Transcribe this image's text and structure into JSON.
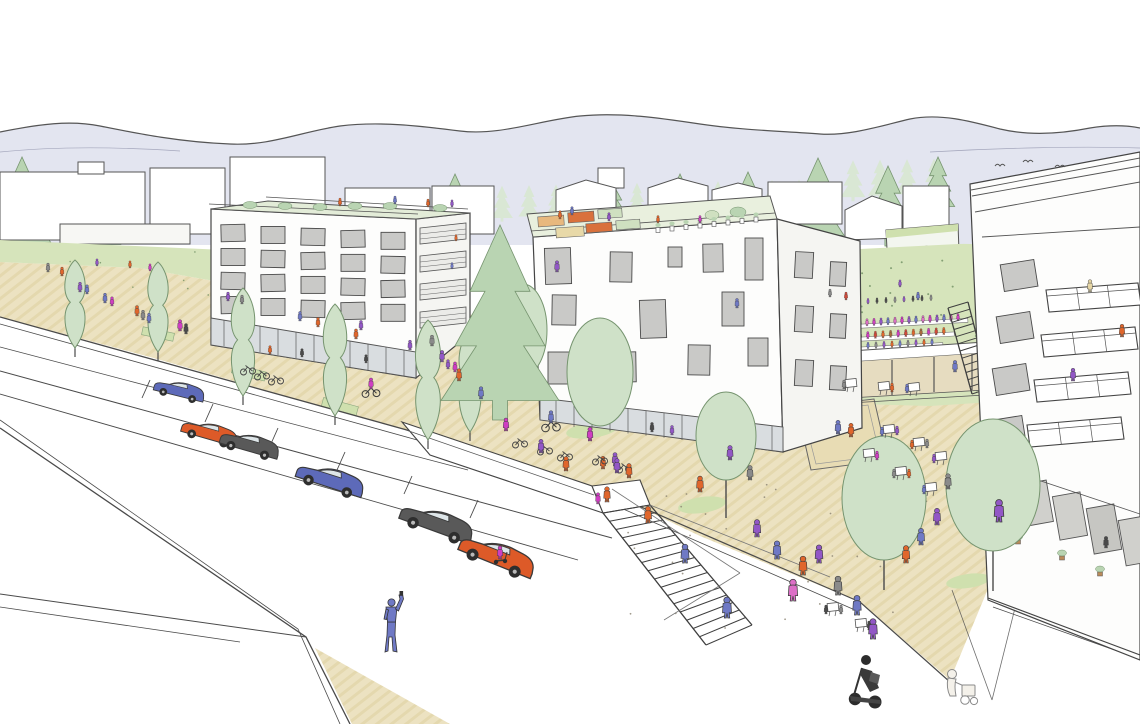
{
  "meta": {
    "title": "Urban design concept sketch",
    "description": "Hand-drawn architectural perspective: two white mid-rise buildings with roof gardens, tree-lined street with parked cars, stepped pedestrian plaza with cafe terraces, terraced restaurant seating on a lawn, tall balcony building at right, mountain ridge in background"
  },
  "palette": {
    "outline": "#4a4a4a",
    "sky_band": "#e3e5f0",
    "paving": "#ece2c1",
    "paving_stripe": "#ddcf9e",
    "lawn": "#d6e4bb",
    "tree_light": "#cfe1c8",
    "tree_mid": "#b9d4b2",
    "tree_bg": "#d9e7d4",
    "tree_stroke": "#76946f",
    "window_gray": "#c9c9c7",
    "glass": "#d9dde0",
    "court_sand": "#e8dcb4",
    "building_white": "#fdfdfc",
    "building_side": "#f5f5f2",
    "white": "#ffffff",
    "people": {
      "orange": "#e0662c",
      "magenta": "#cf3ec2",
      "pink": "#dc6ec6",
      "purple": "#9257c6",
      "violet": "#6f79c5",
      "gray": "#8a8a8a",
      "dark": "#4a4a4a",
      "red": "#cf4a3a",
      "beige": "#e5d5a4",
      "brown": "#a9683c"
    },
    "cars": {
      "blue": "#5d6ab9",
      "orange": "#dd5a28",
      "dark": "#595959"
    }
  },
  "scene": {
    "people_layers": {
      "background": [
        [
          48,
          272,
          "gray",
          0.62
        ],
        [
          62,
          276,
          "orange",
          0.62
        ],
        [
          80,
          292,
          "purple",
          0.68
        ],
        [
          87,
          294,
          "violet",
          0.64
        ],
        [
          105,
          303,
          "violet",
          0.68
        ],
        [
          112,
          306,
          "magenta",
          0.64
        ],
        [
          130,
          268,
          "orange",
          0.5
        ],
        [
          150,
          271,
          "magenta",
          0.5
        ],
        [
          97,
          266,
          "purple",
          0.5
        ],
        [
          137,
          316,
          "orange",
          0.72
        ],
        [
          143,
          320,
          "gray",
          0.68
        ],
        [
          149,
          323,
          "violet",
          0.68
        ],
        [
          180,
          331,
          "magenta",
          0.78
        ],
        [
          186,
          334,
          "dark",
          0.72
        ],
        [
          228,
          301,
          "purple",
          0.62
        ],
        [
          242,
          304,
          "gray",
          0.62
        ],
        [
          300,
          321,
          "violet",
          0.66
        ],
        [
          318,
          327,
          "orange",
          0.66
        ],
        [
          356,
          339,
          "orange",
          0.7
        ],
        [
          410,
          350,
          "purple",
          0.68
        ],
        [
          846,
          300,
          "red",
          0.55
        ],
        [
          830,
          297,
          "gray",
          0.55
        ],
        [
          900,
          287,
          "purple",
          0.5
        ],
        [
          918,
          300,
          "violet",
          0.55
        ]
      ],
      "roof": [
        [
          340,
          206,
          "orange",
          0.55
        ],
        [
          395,
          204,
          "violet",
          0.55
        ],
        [
          428,
          207,
          "orange",
          0.55
        ],
        [
          452,
          207,
          "purple",
          0.5
        ],
        [
          560,
          219,
          "orange",
          0.58
        ],
        [
          572,
          215,
          "violet",
          0.58
        ],
        [
          609,
          221,
          "purple",
          0.58
        ],
        [
          658,
          223,
          "orange",
          0.52
        ],
        [
          700,
          223,
          "magenta",
          0.52
        ]
      ],
      "window": [
        [
          361,
          330,
          "purple",
          0.66
        ],
        [
          557,
          272,
          "purple",
          0.78
        ],
        [
          737,
          308,
          "violet",
          0.66
        ]
      ],
      "balcony": [
        [
          1090,
          292,
          "beige",
          0.85
        ],
        [
          1122,
          337,
          "orange",
          0.88
        ],
        [
          1073,
          381,
          "purple",
          0.88
        ],
        [
          456,
          241,
          "orange",
          0.45
        ],
        [
          452,
          269,
          "violet",
          0.45
        ]
      ],
      "interior": [
        [
          240,
          350,
          "dark",
          0.58
        ],
        [
          270,
          354,
          "orange",
          0.58
        ],
        [
          302,
          357,
          "dark",
          0.58
        ],
        [
          332,
          360,
          "purple",
          0.58
        ],
        [
          366,
          363,
          "dark",
          0.58
        ],
        [
          652,
          432,
          "dark",
          0.66
        ],
        [
          672,
          435,
          "purple",
          0.66
        ],
        [
          700,
          438,
          "dark",
          0.66
        ],
        [
          722,
          440,
          "orange",
          0.66
        ],
        [
          746,
          442,
          "dark",
          0.66
        ],
        [
          1008,
          512,
          "brown",
          0.8
        ],
        [
          1106,
          548,
          "dark",
          0.8
        ]
      ],
      "stairs_bridge": [
        [
          615,
          466,
          "purple",
          0.92
        ],
        [
          603,
          469,
          "orange",
          0.88
        ],
        [
          607,
          502,
          "orange",
          1.05
        ],
        [
          598,
          504,
          "magenta",
          0.78
        ],
        [
          727,
          618,
          "violet",
          1.45
        ],
        [
          793,
          601,
          "pink",
          1.5
        ],
        [
          955,
          372,
          "violet",
          0.8
        ]
      ],
      "plaza": [
        [
          617,
          473,
          "purple",
          1.0
        ],
        [
          629,
          478,
          "orange",
          1.0
        ],
        [
          648,
          523,
          "orange",
          1.15
        ],
        [
          685,
          563,
          "violet",
          1.3
        ],
        [
          757,
          537,
          "purple",
          1.2
        ],
        [
          777,
          559,
          "violet",
          1.25
        ],
        [
          803,
          575,
          "orange",
          1.3
        ],
        [
          819,
          563,
          "purple",
          1.25
        ],
        [
          838,
          595,
          "gray",
          1.3
        ],
        [
          857,
          615,
          "violet",
          1.35
        ],
        [
          873,
          639,
          "purple",
          1.4
        ],
        [
          906,
          563,
          "orange",
          1.2
        ],
        [
          921,
          545,
          "violet",
          1.15
        ],
        [
          937,
          525,
          "purple",
          1.15
        ],
        [
          851,
          437,
          "orange",
          0.95
        ],
        [
          838,
          434,
          "violet",
          0.95
        ],
        [
          999,
          522,
          "purple",
          1.55
        ],
        [
          948,
          489,
          "gray",
          1.05
        ],
        [
          700,
          492,
          "orange",
          1.1
        ],
        [
          590,
          441,
          "magenta",
          0.95
        ],
        [
          566,
          471,
          "orange",
          1.0
        ],
        [
          541,
          453,
          "purple",
          0.95
        ],
        [
          506,
          431,
          "magenta",
          0.9
        ],
        [
          481,
          399,
          "violet",
          0.85
        ],
        [
          459,
          381,
          "orange",
          0.85
        ],
        [
          442,
          362,
          "purple",
          0.8
        ],
        [
          432,
          346,
          "gray",
          0.75
        ],
        [
          750,
          480,
          "gray",
          1.0
        ],
        [
          730,
          460,
          "purple",
          1.0
        ],
        [
          455,
          372,
          "magenta",
          0.7
        ],
        [
          448,
          369,
          "purple",
          0.65
        ]
      ]
    },
    "cars": [
      [
        178,
        396,
        0.85,
        14,
        "blue"
      ],
      [
        208,
        439,
        0.95,
        16,
        "orange"
      ],
      [
        248,
        451,
        1.0,
        16,
        "dark"
      ],
      [
        328,
        487,
        1.15,
        18,
        "blue"
      ],
      [
        434,
        531,
        1.25,
        20,
        "dark"
      ],
      [
        494,
        564,
        1.3,
        22,
        "orange"
      ]
    ],
    "trees": {
      "columnar": [
        [
          75,
          348,
          88,
          26
        ],
        [
          158,
          352,
          90,
          26
        ],
        [
          243,
          396,
          108,
          30
        ],
        [
          335,
          416,
          112,
          30
        ],
        [
          428,
          440,
          120,
          32
        ],
        [
          470,
          432,
          102,
          28
        ]
      ],
      "round": [
        [
          600,
          372,
          33,
          54,
          0
        ],
        [
          523,
          330,
          24,
          46,
          0
        ],
        [
          726,
          436,
          30,
          44,
          38
        ],
        [
          884,
          498,
          42,
          62,
          30
        ],
        [
          993,
          485,
          47,
          66,
          40
        ]
      ],
      "conifer_front": [
        [
          500,
          420,
          195
        ]
      ],
      "conifer_bg": [
        [
          22,
          252,
          95
        ],
        [
          95,
          253,
          85
        ],
        [
          262,
          252,
          78
        ],
        [
          455,
          232,
          58
        ],
        [
          818,
          244,
          86
        ],
        [
          888,
          246,
          80
        ],
        [
          938,
          212,
          55
        ],
        [
          612,
          216,
          42
        ],
        [
          680,
          214,
          40
        ],
        [
          748,
          216,
          44
        ]
      ]
    },
    "seating_rows": [
      {
        "x0": 850,
        "y": 305,
        "dx": 9.0,
        "n": 10,
        "slope": -0.055,
        "s": 0.4,
        "bench": false,
        "colors": [
          "dark",
          "gray",
          "purple",
          "dark"
        ]
      },
      {
        "x0": 846,
        "y": 327,
        "dx": 7.0,
        "n": 17,
        "slope": -0.055,
        "s": 0.5,
        "bench": true,
        "colors": [
          "magenta",
          "purple",
          "violet",
          "pink"
        ]
      },
      {
        "x0": 845,
        "y": 340,
        "dx": 7.6,
        "n": 14,
        "slope": -0.055,
        "s": 0.5,
        "bench": true,
        "colors": [
          "red",
          "orange",
          "brown",
          "magenta"
        ]
      },
      {
        "x0": 844,
        "y": 350,
        "dx": 8.0,
        "n": 12,
        "slope": -0.055,
        "s": 0.45,
        "bench": true,
        "colors": [
          "gray",
          "purple",
          "orange",
          "violet"
        ]
      }
    ],
    "tables": [
      {
        "x": 889,
        "y": 429,
        "seats": [
          [
            -7,
            3,
            "violet"
          ],
          [
            8,
            2,
            "purple"
          ]
        ]
      },
      {
        "x": 919,
        "y": 442,
        "seats": [
          [
            -7,
            3,
            "orange"
          ],
          [
            8,
            2,
            "gray"
          ]
        ]
      },
      {
        "x": 941,
        "y": 456,
        "seats": [
          [
            -7,
            3,
            "purple"
          ]
        ]
      },
      {
        "x": 869,
        "y": 453,
        "seats": [
          [
            8,
            3,
            "magenta"
          ]
        ]
      },
      {
        "x": 901,
        "y": 471,
        "seats": [
          [
            -7,
            3,
            "gray"
          ],
          [
            8,
            3,
            "orange"
          ]
        ]
      },
      {
        "x": 931,
        "y": 487,
        "seats": [
          [
            -7,
            3,
            "violet"
          ]
        ]
      },
      {
        "x": 833,
        "y": 607,
        "seats": [
          [
            -7,
            3,
            "dark"
          ],
          [
            8,
            3,
            "gray"
          ]
        ]
      },
      {
        "x": 861,
        "y": 623,
        "seats": [
          [
            8,
            3,
            "dark"
          ]
        ]
      },
      {
        "x": 851,
        "y": 383,
        "seats": [
          [
            -7,
            2,
            "gray"
          ]
        ]
      },
      {
        "x": 884,
        "y": 386,
        "seats": [
          [
            8,
            2,
            "orange"
          ]
        ]
      },
      {
        "x": 914,
        "y": 387,
        "seats": [
          [
            -7,
            2,
            "violet"
          ]
        ]
      }
    ],
    "stairs": [
      {
        "l": [
          603,
          513,
          706,
          645
        ],
        "r": [
          650,
          505,
          752,
          625
        ],
        "n": 16
      },
      {
        "l": [
          948,
          308,
          972,
          394
        ],
        "r": [
          968,
          302,
          990,
          388
        ],
        "n": 12
      }
    ],
    "bikes": [
      [
        248,
        372
      ],
      [
        262,
        377
      ],
      [
        276,
        382
      ],
      [
        520,
        445
      ],
      [
        545,
        452
      ],
      [
        565,
        458
      ],
      [
        600,
        462
      ],
      [
        624,
        470
      ]
    ],
    "cyclists": [
      [
        371,
        394,
        "magenta",
        0.9
      ],
      [
        551,
        428,
        "violet",
        1.0
      ]
    ],
    "scooters": [
      [
        500,
        561,
        "magenta"
      ]
    ],
    "left_win_grid": {
      "cols": 5,
      "rows": 4,
      "x0": 221,
      "dx": 40,
      "ys": [
        224,
        248,
        272,
        296
      ],
      "w": 24,
      "h": 17,
      "slope": 0.049,
      "xref": 211
    },
    "mid_windows": [
      [
        545,
        248,
        26,
        36,
        -2
      ],
      [
        610,
        252,
        22,
        30,
        1
      ],
      [
        668,
        247,
        14,
        20,
        0
      ],
      [
        703,
        244,
        20,
        28,
        -1
      ],
      [
        745,
        238,
        18,
        42,
        0
      ],
      [
        552,
        295,
        24,
        30,
        1
      ],
      [
        640,
        300,
        26,
        38,
        -2
      ],
      [
        722,
        292,
        22,
        34,
        0
      ],
      [
        548,
        352,
        26,
        32,
        0
      ],
      [
        612,
        352,
        24,
        30,
        -1
      ],
      [
        688,
        345,
        22,
        30,
        1
      ],
      [
        748,
        338,
        20,
        28,
        0
      ],
      [
        795,
        252,
        18,
        26,
        3
      ],
      [
        830,
        262,
        16,
        24,
        3
      ],
      [
        795,
        306,
        18,
        26,
        3
      ],
      [
        830,
        314,
        16,
        24,
        3
      ],
      [
        795,
        360,
        18,
        26,
        3
      ],
      [
        830,
        366,
        16,
        24,
        3
      ]
    ],
    "right_windows": [
      [
        1002,
        262
      ],
      [
        998,
        314
      ],
      [
        994,
        366
      ],
      [
        990,
        418
      ],
      [
        987,
        470
      ]
    ],
    "balconies": [
      [
        1046,
        290,
        1138,
        283
      ],
      [
        1041,
        335,
        1135,
        327
      ],
      [
        1034,
        380,
        1128,
        372
      ],
      [
        1027,
        425,
        1121,
        417
      ]
    ],
    "left_side_balcony_rows": [
      228,
      256,
      284,
      312
    ],
    "arcade_panels": [
      [
        995,
        472,
        26,
        40,
        "#cfddc9"
      ],
      [
        1024,
        482,
        26,
        42,
        "#d0d0cc"
      ],
      [
        1056,
        494,
        28,
        44,
        "#d0d0cc"
      ],
      [
        1090,
        506,
        28,
        46,
        "#c6c6c2"
      ],
      [
        1122,
        518,
        26,
        46,
        "#d0d0cc"
      ]
    ],
    "arcade_pots": [
      [
        1018,
        542
      ],
      [
        1062,
        558
      ],
      [
        1100,
        574
      ]
    ],
    "roof_pots": {
      "x0": 658,
      "y0": 230,
      "dx": 14,
      "n": 8,
      "dy": -1.5
    },
    "glazing": [
      {
        "x0": 224,
        "x1": 410,
        "step": 18,
        "xa": 211,
        "ya": 318,
        "xb": 416,
        "yb": 352,
        "h": 26
      },
      {
        "x0": 556,
        "x1": 778,
        "step": 18,
        "xa": 540,
        "ya": 398,
        "xb": 783,
        "yb": 427,
        "h": 25
      }
    ],
    "speckles": [
      {
        "x": 805,
        "y": 258,
        "w": 180,
        "h": 135,
        "n": 45,
        "c": "#6f8f63",
        "r": 1.0
      },
      {
        "x": 600,
        "y": 480,
        "w": 340,
        "h": 150,
        "n": 26,
        "c": "#8a8270",
        "r": 0.9
      },
      {
        "x": 60,
        "y": 250,
        "w": 250,
        "h": 45,
        "n": 18,
        "c": "#6f8f63",
        "r": 0.8
      },
      {
        "x": 808,
        "y": 412,
        "w": 68,
        "h": 50,
        "n": 12,
        "c": "#555555",
        "r": 1.1
      }
    ],
    "bg_band": {
      "x0": 340,
      "x1": 955,
      "step": 27,
      "y_at_x0": 231,
      "drop": 0.058
    },
    "birds": [
      [
        1000,
        166
      ],
      [
        1028,
        162
      ],
      [
        1060,
        167
      ]
    ]
  }
}
